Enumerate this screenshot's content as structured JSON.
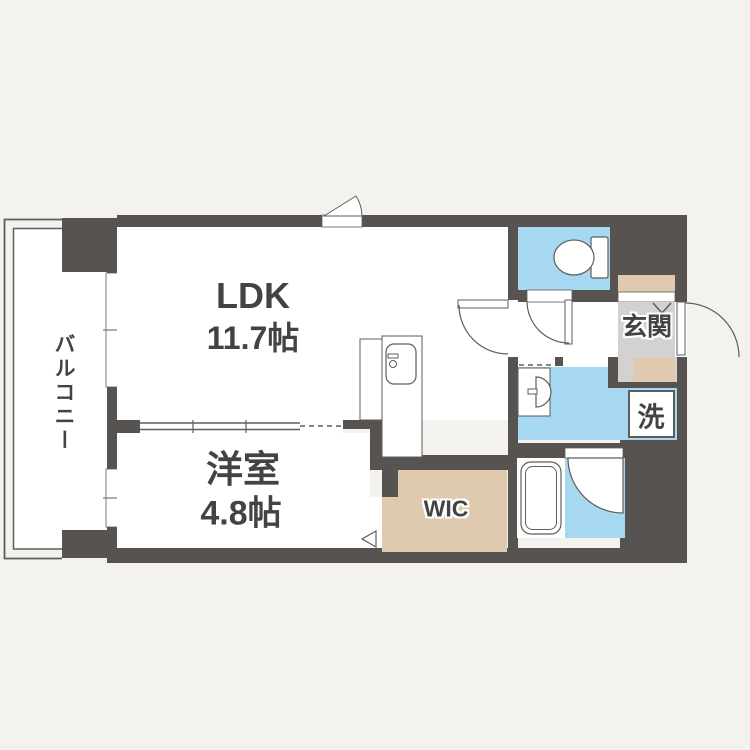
{
  "colors": {
    "background": "#f4f2ef",
    "wall": "#575350",
    "water": "#a7d8f1",
    "step": "#dfcab0",
    "entrance_floor": "#d3d2d0",
    "room": "#ffffff",
    "line": "#5f5d5b",
    "text": "#434343"
  },
  "rooms": {
    "balcony": {
      "label": "バルコニー"
    },
    "ldk": {
      "label": "LDK",
      "size": "11.7帖"
    },
    "bedroom": {
      "label": "洋室",
      "size": "4.8帖"
    },
    "wic": {
      "label": "WIC"
    },
    "entrance": {
      "label": "玄関"
    },
    "laundry": {
      "label": "洗"
    }
  }
}
